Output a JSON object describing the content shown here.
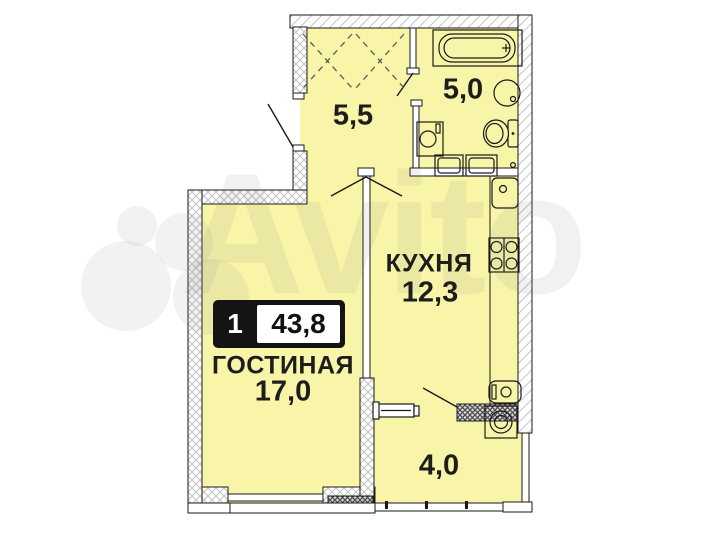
{
  "plan": {
    "badge": {
      "rooms": "1",
      "total_area": "43,8"
    },
    "rooms": {
      "hallway": {
        "area": "5,5"
      },
      "bathroom": {
        "area": "5,0"
      },
      "kitchen": {
        "name": "КУХНЯ",
        "area": "12,3"
      },
      "living": {
        "name": "ГОСТИНАЯ",
        "area": "17,0"
      },
      "balcony": {
        "area": "4,0"
      }
    },
    "watermark": "Avito",
    "fixtures": [
      "bathtub-icon",
      "bath-sink-icon",
      "toilet-icon",
      "washing-machine-icon",
      "bath-cabinets-icon",
      "kitchen-sink-icon",
      "stove-icon",
      "water-heater-icon",
      "radiator-icon",
      "wardrobe-icon",
      "balcony-washer-icon"
    ],
    "colors": {
      "room_fill": "#f8f5a8",
      "wall_stroke": "#1a1a1a",
      "hatch_light": "#bdbdbd",
      "hatch_dark": "#4a4a4a",
      "badge_bg": "#141414",
      "badge_text": "#ffffff"
    }
  }
}
